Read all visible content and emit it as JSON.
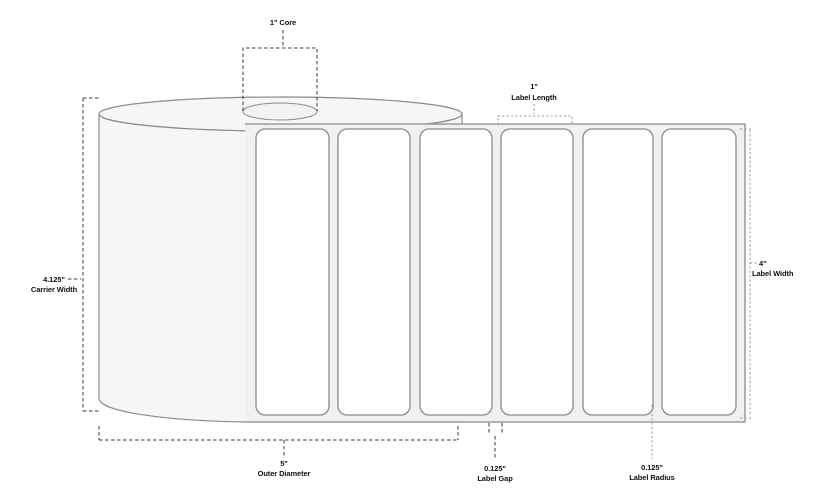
{
  "colors": {
    "bg": "#ffffff",
    "outline": "#8b8b8b",
    "roll_fill": "#f6f6f6",
    "liner_fill": "#f0f0f0",
    "label_fill": "#ffffff",
    "core_fill": "#f2f2f2",
    "dash_dark": "#3a3a3a",
    "dash_light": "#9a9a9a",
    "ink": "#111111"
  },
  "diagram": {
    "subject": "label-roll-dimension-diagram",
    "label_count": 6,
    "annotations": {
      "core": {
        "text": "1\" Core"
      },
      "label_length": {
        "value": "1\"",
        "label": "Label Length"
      },
      "carrier_width": {
        "value": "4.125\"",
        "label": "Carrier Width"
      },
      "label_width": {
        "value": "4\"",
        "label": "Label Width"
      },
      "outer_diameter": {
        "value": "5\"",
        "label": "Outer Diameter"
      },
      "label_gap": {
        "value": "0.125\"",
        "label": "Label Gap"
      },
      "label_radius": {
        "value": "0.125\"",
        "label": "Label Radius"
      }
    }
  }
}
